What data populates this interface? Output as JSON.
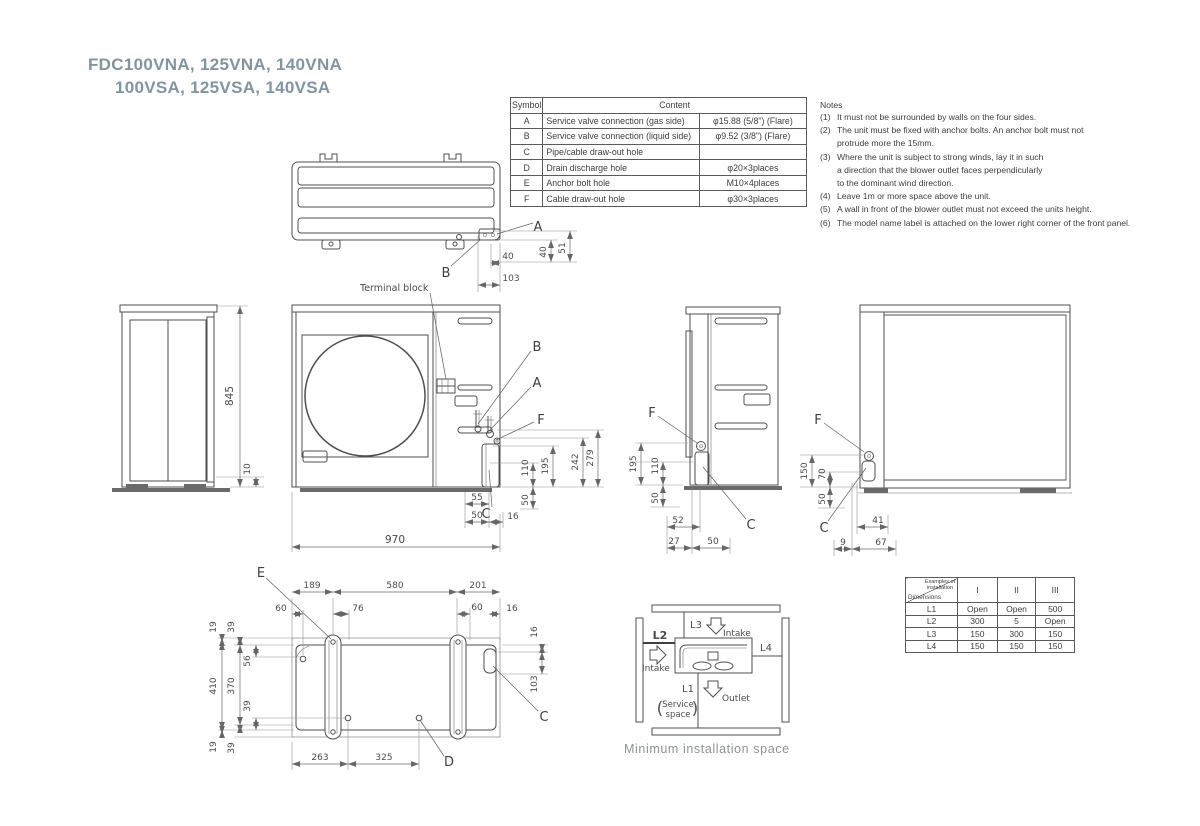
{
  "colors": {
    "title": "#8095a0",
    "caption": "#8d9494",
    "line": "#4f4f4f"
  },
  "title": {
    "line1": "FDC100VNA, 125VNA, 140VNA",
    "line2": "100VSA, 125VSA, 140VSA"
  },
  "symbol_table": {
    "header_symbol": "Symbol",
    "header_content": "Content",
    "rows": [
      {
        "symbol": "A",
        "content": "Service valve connection (gas side)",
        "value": "φ15.88 (5/8\") (Flare)"
      },
      {
        "symbol": "B",
        "content": "Service valve connection (liquid side)",
        "value": "φ9.52 (3/8\") (Flare)"
      },
      {
        "symbol": "C",
        "content": "Pipe/cable draw-out hole",
        "value": ""
      },
      {
        "symbol": "D",
        "content": "Drain discharge hole",
        "value": "φ20×3places"
      },
      {
        "symbol": "E",
        "content": "Anchor bolt hole",
        "value": "M10×4places"
      },
      {
        "symbol": "F",
        "content": "Cable draw-out hole",
        "value": "φ30×3places"
      }
    ]
  },
  "notes": {
    "heading": "Notes",
    "items": [
      {
        "num": "(1)",
        "text": "It must not be surrounded by walls on the four sides."
      },
      {
        "num": "(2)",
        "text": "The unit must be fixed with anchor bolts. An anchor bolt must not"
      },
      {
        "num": "",
        "text": "protrude more the 15mm."
      },
      {
        "num": "(3)",
        "text": "Where the unit is subject to strong winds, lay it in such"
      },
      {
        "num": "",
        "text": "a direction that the blower outlet faces perpendicularly"
      },
      {
        "num": "",
        "text": "to the dominant wind direction."
      },
      {
        "num": "(4)",
        "text": "Leave 1m or more space above the unit."
      },
      {
        "num": "(5)",
        "text": "A wall in front of the blower outlet must not exceed the units height."
      },
      {
        "num": "(6)",
        "text": "The model name label is attached on the lower right corner of the front panel."
      }
    ]
  },
  "views": {
    "top": {
      "letter_a": "A",
      "letter_b": "B",
      "d40w": "40",
      "d103": "103",
      "d40h": "40",
      "d51": "51"
    },
    "left": {
      "d845": "845",
      "d10": "10"
    },
    "front": {
      "letter_b": "B",
      "letter_a": "A",
      "letter_f": "F",
      "letter_c": "C",
      "terminal_block": "Terminal block",
      "d110": "110",
      "d195": "195",
      "d242": "242",
      "d279": "279",
      "d50v": "50",
      "d55": "55",
      "d50b": "50",
      "d16": "16",
      "d970": "970"
    },
    "side": {
      "letter_f": "F",
      "letter_c": "C",
      "d195": "195",
      "d110": "110",
      "d50v": "50",
      "d52": "52",
      "d27": "27",
      "d50b": "50"
    },
    "rear": {
      "letter_f": "F",
      "letter_c": "C",
      "d150": "150",
      "d70": "70",
      "d50": "50",
      "d41": "41",
      "d9": "9",
      "d67": "67"
    },
    "bottom": {
      "letter_e": "E",
      "letter_d": "D",
      "letter_c": "C",
      "d189": "189",
      "d580": "580",
      "d201": "201",
      "d60a": "60",
      "d76": "76",
      "d60b": "60",
      "d16a": "16",
      "d19a": "19",
      "d39a": "39",
      "d56": "56",
      "d410": "410",
      "d370": "370",
      "d39b": "39",
      "d19b": "19",
      "d39c": "39",
      "d16r": "16",
      "d103": "103",
      "d263": "263",
      "d325": "325"
    }
  },
  "install": {
    "l1": "L1",
    "l2": "L2",
    "l3": "L3",
    "l4": "L4",
    "intake_top": "Intake",
    "intake_left": "Intake",
    "outlet": "Outlet",
    "paren_l": "(",
    "service1": "Service",
    "service2": "space",
    "paren_r": ")",
    "caption": "Minimum installation space"
  },
  "install_table": {
    "corner_line1": "Examples of",
    "corner_line2": "installation",
    "corner_bottom": "Dimensions",
    "cols": [
      "I",
      "II",
      "III"
    ],
    "rows": [
      {
        "label": "L1",
        "values": [
          "Open",
          "Open",
          "500"
        ]
      },
      {
        "label": "L2",
        "values": [
          "300",
          "5",
          "Open"
        ]
      },
      {
        "label": "L3",
        "values": [
          "150",
          "300",
          "150"
        ]
      },
      {
        "label": "L4",
        "values": [
          "150",
          "150",
          "150"
        ]
      }
    ]
  }
}
